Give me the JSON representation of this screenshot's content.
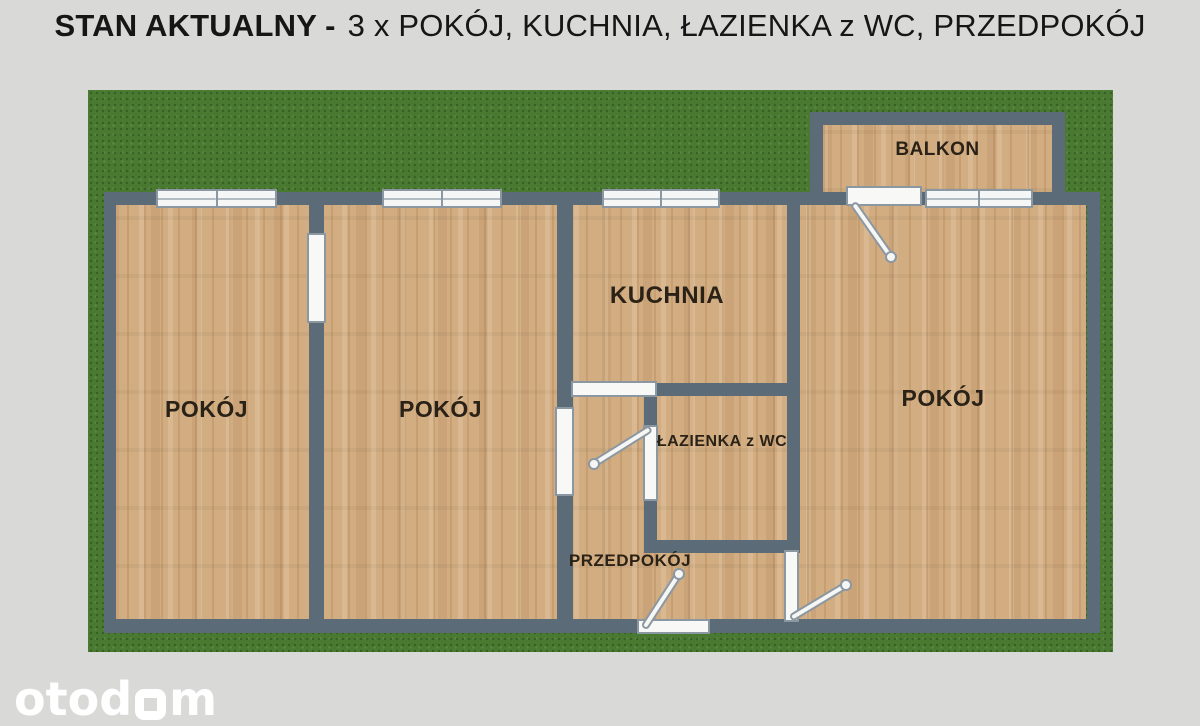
{
  "title": {
    "bold": "STAN AKTUALNY",
    "separator": "-",
    "rest": "3 x POKÓJ, KUCHNIA, ŁAZIENKA z WC, PRZEDPOKÓJ"
  },
  "rooms": {
    "room1": "POKÓJ",
    "room2": "POKÓJ",
    "room3": "POKÓJ",
    "kitchen": "KUCHNIA",
    "bathroom": "ŁAZIENKA z WC",
    "hallway": "PRZEDPOKÓJ",
    "balcony": "BALKON"
  },
  "branding": {
    "logo_prefix": "otod",
    "logo_suffix": "m",
    "logo_full": "otodom"
  },
  "colors": {
    "background": "#d9dad8",
    "grass": "#4a7a31",
    "wall": "#5b6b77",
    "floor": "#d3ad82",
    "opening_outline": "#8b97a1",
    "label_text": "#2a2217",
    "title_text": "#161616",
    "logo": "#ffffff"
  }
}
